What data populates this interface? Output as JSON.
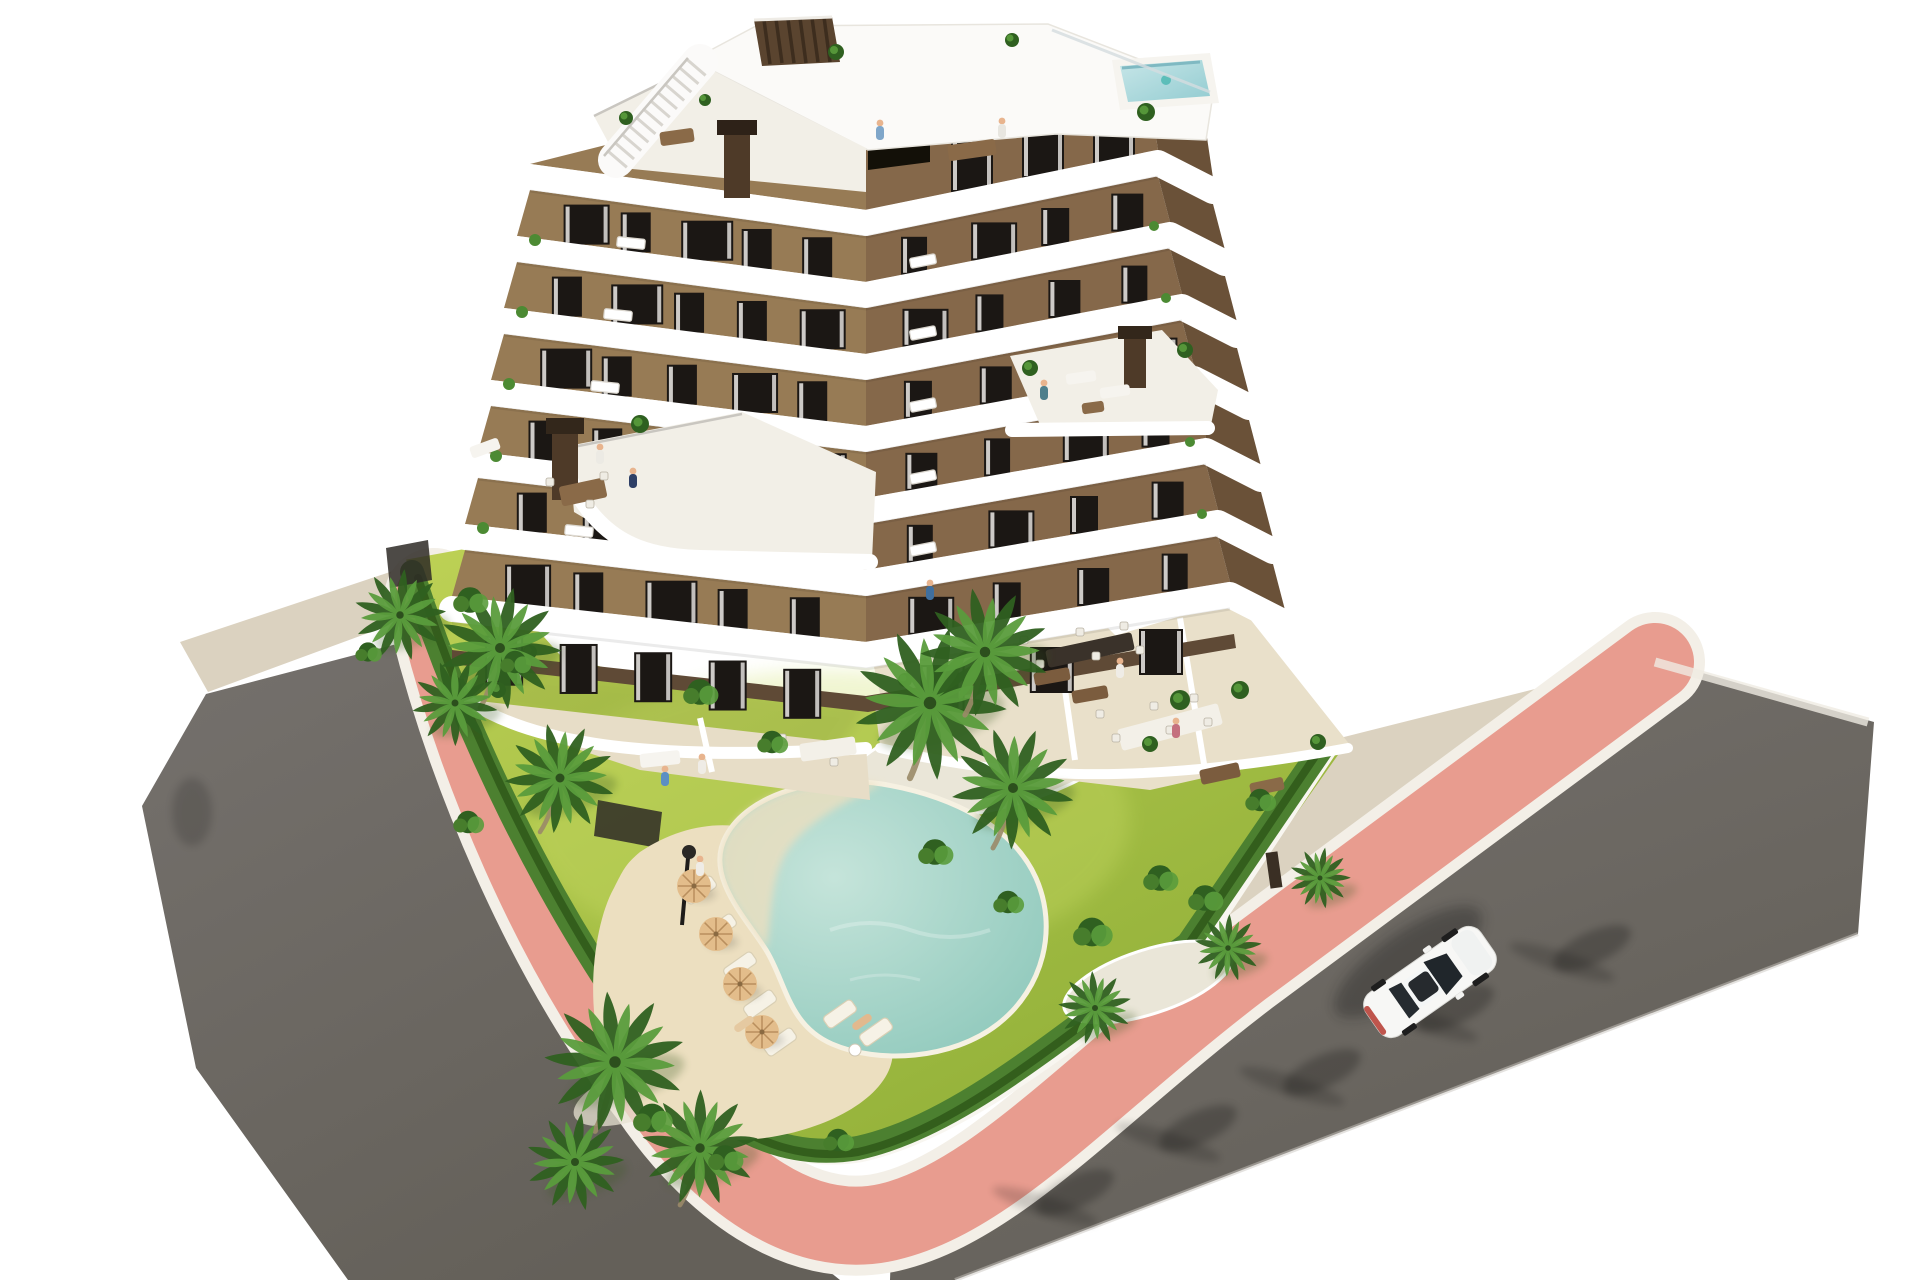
{
  "scene": {
    "kind": "aerial-architectural-render",
    "subject": "modern-apartment-building-with-pool-garden",
    "background": "#ffffff"
  },
  "palette": {
    "background": "#ffffff",
    "asphalt": "#75716d",
    "asphalt_dark": "#646059",
    "sidewalk_pink": "#e89c8f",
    "curb_white": "#f3efe7",
    "verge": "#dbd2c0",
    "lawn_light": "#bdd155",
    "lawn_dark": "#8fae37",
    "hedge": "#4c8030",
    "hedge_shadow": "#2d5518",
    "palm_light": "#5a9c3c",
    "palm_dark": "#2f6020",
    "facade_light": "#977b55",
    "facade_mid": "#85684a",
    "facade_dark": "#6a5138",
    "band_white": "#ffffff",
    "window_dark": "#1b1714",
    "curtain": "#eceae6",
    "terrace_tile": "#e7ddc7",
    "courtyard_dark": "#241d16",
    "plinth": "#5f4a36",
    "pool_light": "#c5e4da",
    "pool_deep": "#8cc7ba",
    "sand": "#ecdfc0",
    "parasol": "#e3bd8b",
    "wood": "#8a6a48",
    "car_white": "#f7f7f5",
    "taillight_red": "#b8423a",
    "roofpool_light": "#c7e6e8",
    "roofpool_deep": "#93ccd1",
    "chimney": "#4e3a28",
    "skin": "#e8b48e",
    "shadow": "#1d1c1a"
  },
  "objects": {
    "building": {
      "floors_visible": 7,
      "facade": "brown stucco",
      "balconies": "white curved wrap-around bands",
      "roof_features": [
        "roof terrace",
        "stair",
        "slatted bulkhead",
        "small rooftop pool",
        "chimneys",
        "plants"
      ]
    },
    "pool": {
      "shape": "boomerang",
      "water": "turquoise",
      "beach_entry": true
    },
    "rooftop_pool": 1,
    "roads": 2,
    "sidewalks": "pink paved band with white curbs",
    "vehicle": {
      "type": "car",
      "color": "white",
      "count": 1
    },
    "vegetation": {
      "palm_trees": 13,
      "hedge_border": true,
      "lawn": true,
      "bushes": 15
    },
    "pool_furniture": {
      "sun_loungers": 7,
      "parasols": 4,
      "lamp_post": 1
    },
    "people_visible": 13
  }
}
